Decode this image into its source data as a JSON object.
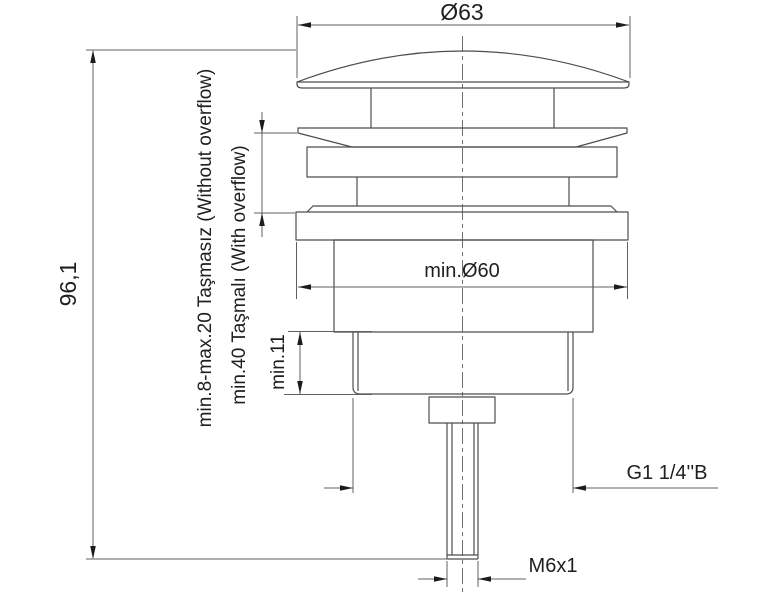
{
  "drawing": {
    "type": "technical-dimension-drawing",
    "subject": "pop-up drain valve side view",
    "labels": {
      "dia_top": "Ø63",
      "height_total": "96,1",
      "min_hole": "min.Ø60",
      "thread_len": "min.11",
      "thread_spec": "G1 1/4''B",
      "stud_spec": "M6x1",
      "without_overflow": "min.8-max.20 Taşmasız (Without overflow)",
      "with_overflow": "min.40 Taşmalı (With overflow)"
    },
    "colors": {
      "outline": "#4d4d4d",
      "dimension": "#606060",
      "text": "#1f1f1f",
      "background": "#ffffff"
    }
  }
}
